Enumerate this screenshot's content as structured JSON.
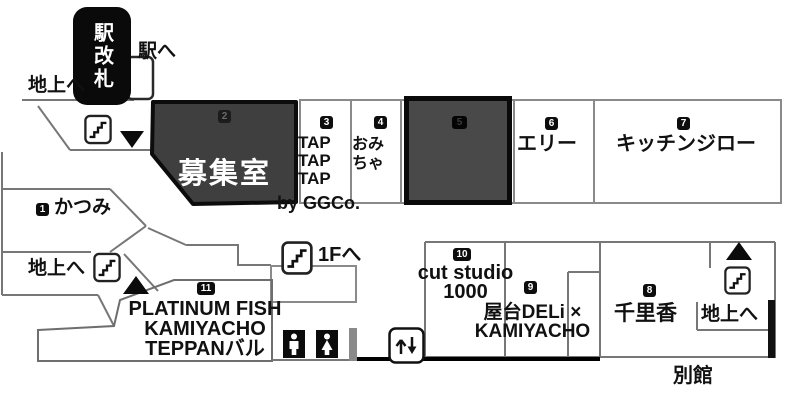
{
  "signs": {
    "station_gate": "駅改札",
    "to_station": "駅へ",
    "to_ground": "地上へ",
    "to_1f": "1Fへ",
    "annex": "別館"
  },
  "units": {
    "u1": {
      "no": "1",
      "label": "かつみ"
    },
    "u2": {
      "no": "2",
      "label": "募集室"
    },
    "u3": {
      "no": "3",
      "lines": [
        "TAP",
        "TAP",
        "TAP"
      ],
      "suffix": "by GGCo."
    },
    "u4": {
      "no": "4",
      "lines": [
        "おみ",
        "ちゃ"
      ]
    },
    "u5": {
      "no": "5",
      "label": ""
    },
    "u6": {
      "no": "6",
      "label": "エリー"
    },
    "u7": {
      "no": "7",
      "label": "キッチンジロー"
    },
    "u8": {
      "no": "8",
      "label": "千里香"
    },
    "u9": {
      "no": "9",
      "lines": [
        "屋台DELi ×",
        "KAMIYACHO"
      ]
    },
    "u10": {
      "no": "10",
      "lines": [
        "cut studio",
        "1000"
      ]
    },
    "u11": {
      "no": "11",
      "lines": [
        "PLATINUM FISH",
        "KAMIYACHO",
        "TEPPANバル"
      ]
    }
  },
  "icons": {
    "stairs": "stairs-icon",
    "elevator": "elevator-icon",
    "restroom_male": "restroom-male-icon",
    "restroom_female": "restroom-female-icon",
    "triangle_up": "direction-triangle-up",
    "triangle_down": "direction-triangle-down"
  },
  "colors": {
    "vacant_room": "#3f3f3f",
    "dark_room": "#494949",
    "wall": "#777777",
    "badge_bg": "#0d0d0d"
  }
}
